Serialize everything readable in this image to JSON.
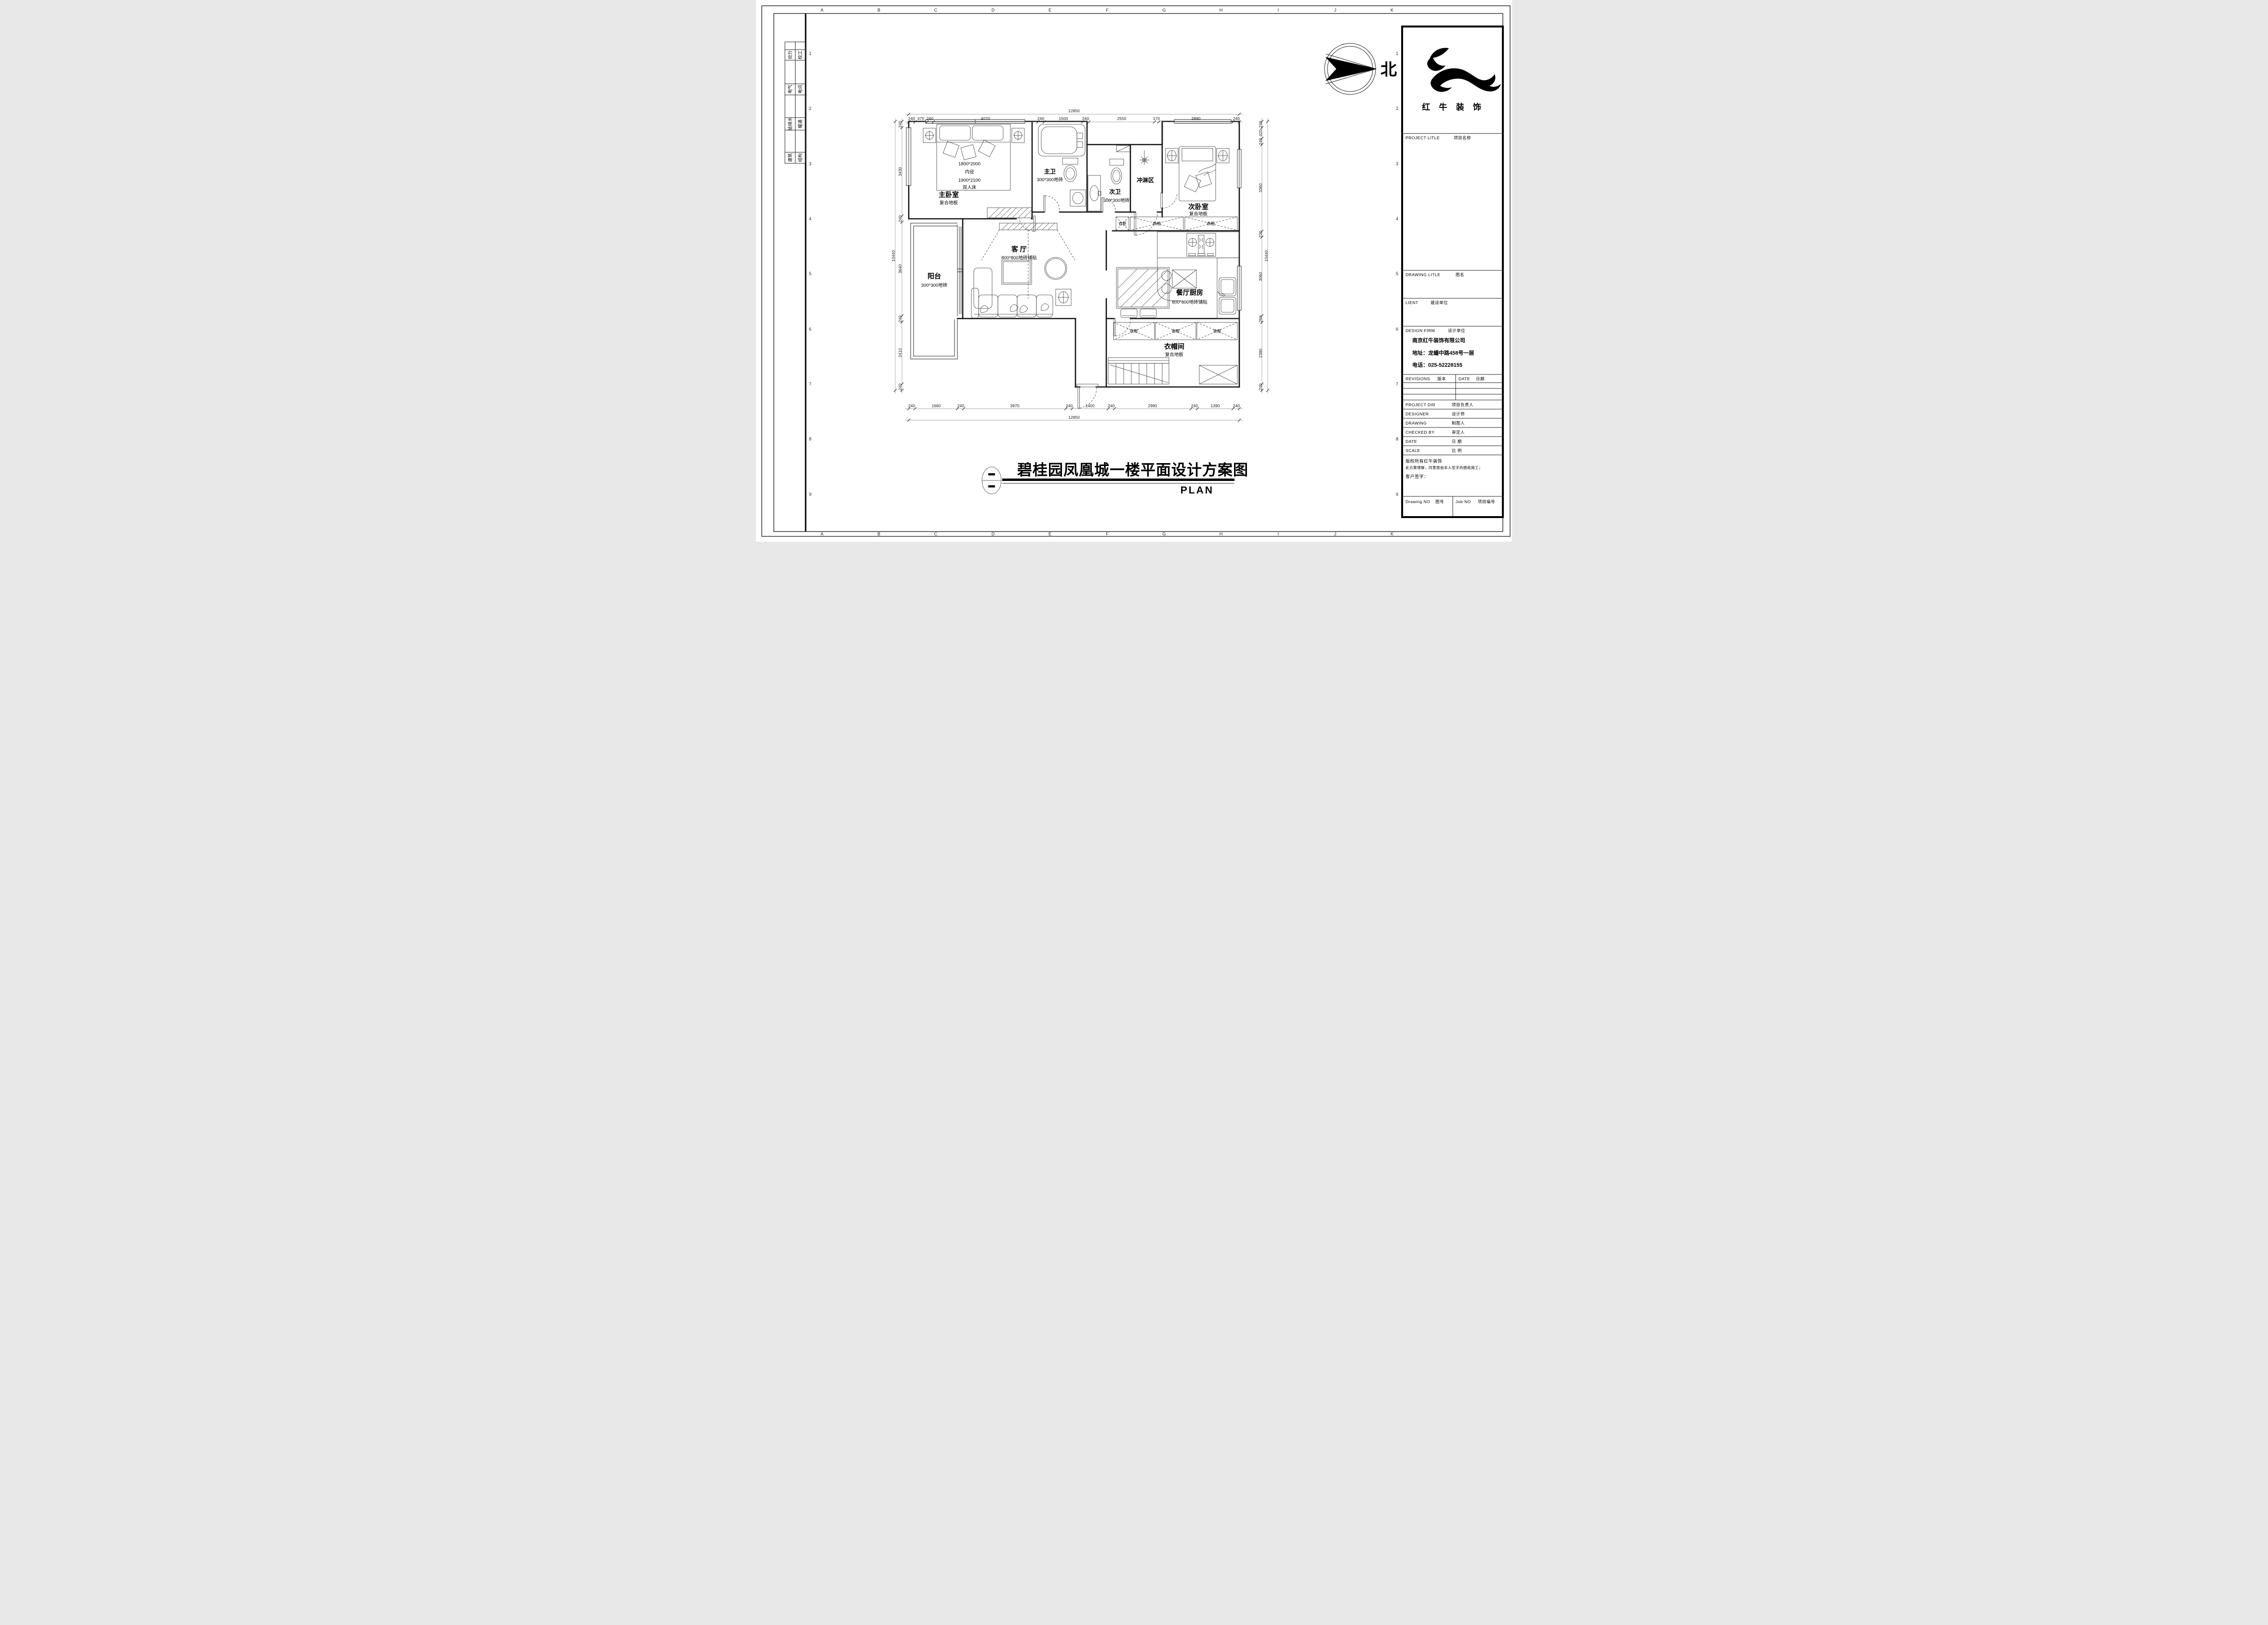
{
  "drawing_title": {
    "main": "碧桂园凤凰城一楼平面设计方案图",
    "plan_label": "PLAN"
  },
  "compass": {
    "north_label": "北"
  },
  "rooms": {
    "master_bedroom": {
      "name": "主卧室",
      "floor": "复合地板"
    },
    "bed_specs": {
      "line1": "1800*2000",
      "line2": "内径",
      "line3": "1900*2100",
      "line4": "双人床"
    },
    "master_bath": {
      "name": "主卫",
      "floor": "300*300地砖"
    },
    "second_bath": {
      "name": "次卫",
      "floor": "300*300地砖"
    },
    "shower": {
      "name": "冲淋区"
    },
    "second_bedroom": {
      "name": "次卧室",
      "floor": "复合地板"
    },
    "living_room": {
      "name": "客 厅",
      "floor": "800*800地砖铺贴"
    },
    "balcony": {
      "name": "阳台",
      "floor": "300*300地砖"
    },
    "kitchen_dining": {
      "name": "餐厅厨房",
      "floor": "800*800地砖铺贴"
    },
    "cloakroom": {
      "name": "衣帽间",
      "floor": "复合地板"
    },
    "wardrobe": "衣柜"
  },
  "dimensions": {
    "top": {
      "total": "12850",
      "segs": [
        "240",
        "470",
        "240",
        "4070",
        "240",
        "1500",
        "240",
        "2550",
        "170",
        "2890",
        "240"
      ]
    },
    "bottom": {
      "total": "12850",
      "segs": [
        "240",
        "1660",
        "240",
        "3970",
        "240",
        "1400",
        "240",
        "2990",
        "240",
        "1390",
        "240"
      ]
    },
    "left": {
      "total": "10440",
      "segs": [
        "240",
        "3430",
        "240",
        "3640",
        "240",
        "2410",
        "240"
      ]
    },
    "right": {
      "total": "10440",
      "segs": [
        "240",
        "420",
        "240",
        "3360",
        "230",
        "3060",
        "260",
        "2390",
        "240"
      ]
    }
  },
  "sheet": {
    "grid_letters": [
      "A",
      "B",
      "C",
      "D",
      "E",
      "F",
      "G",
      "H",
      "I",
      "J",
      "K"
    ],
    "grid_numbers": [
      "1",
      "2",
      "3",
      "4",
      "5",
      "6",
      "7",
      "8",
      "9"
    ],
    "stamps": [
      {
        "a": "动力",
        "b": "校工"
      },
      {
        "a": "电气",
        "b": "电讯"
      },
      {
        "a": "给排水",
        "b": "暖通"
      },
      {
        "a": "建筑",
        "b": "结构"
      }
    ]
  },
  "title_block": {
    "logo_text": "红 牛 装 饰",
    "project_label": "PROJECT LITLE",
    "project_cn": "项目名称",
    "drawing_label": "DRAWING LITLE",
    "drawing_cn": "图名",
    "client_label": "LIENT",
    "client_cn": "建设单位",
    "firm_label": "DESIGN FIRM",
    "firm_cn": "设计单位",
    "company": "南京红牛装饰有限公司",
    "address": "地址：龙蟠中路458号一层",
    "phone": "电话：025-52228155",
    "revisions_label": "REVISIONS",
    "revisions_cn": "版本",
    "date_label": "DATE",
    "date_cn": "日期",
    "rows": [
      {
        "en": "PROJECT DIR",
        "cn": "项目负责人"
      },
      {
        "en": "DESIGNER",
        "cn": "设计师"
      },
      {
        "en": "DRAWING",
        "cn": "制图人"
      },
      {
        "en": "CHECKED BY",
        "cn": "审定人"
      },
      {
        "en": "DATE",
        "cn": "日  期"
      },
      {
        "en": "SCALE",
        "cn": "比  例"
      }
    ],
    "copyright1": "版权所有红牛装饰",
    "copyright2": "此方案理解，同意按由本人签字的图纸施工；",
    "sign": "客户签字：",
    "drawing_no_label": "Drawing NO",
    "drawing_no_cn": "图号",
    "job_no_label": "Job NO",
    "job_no_cn": "项目编号"
  }
}
